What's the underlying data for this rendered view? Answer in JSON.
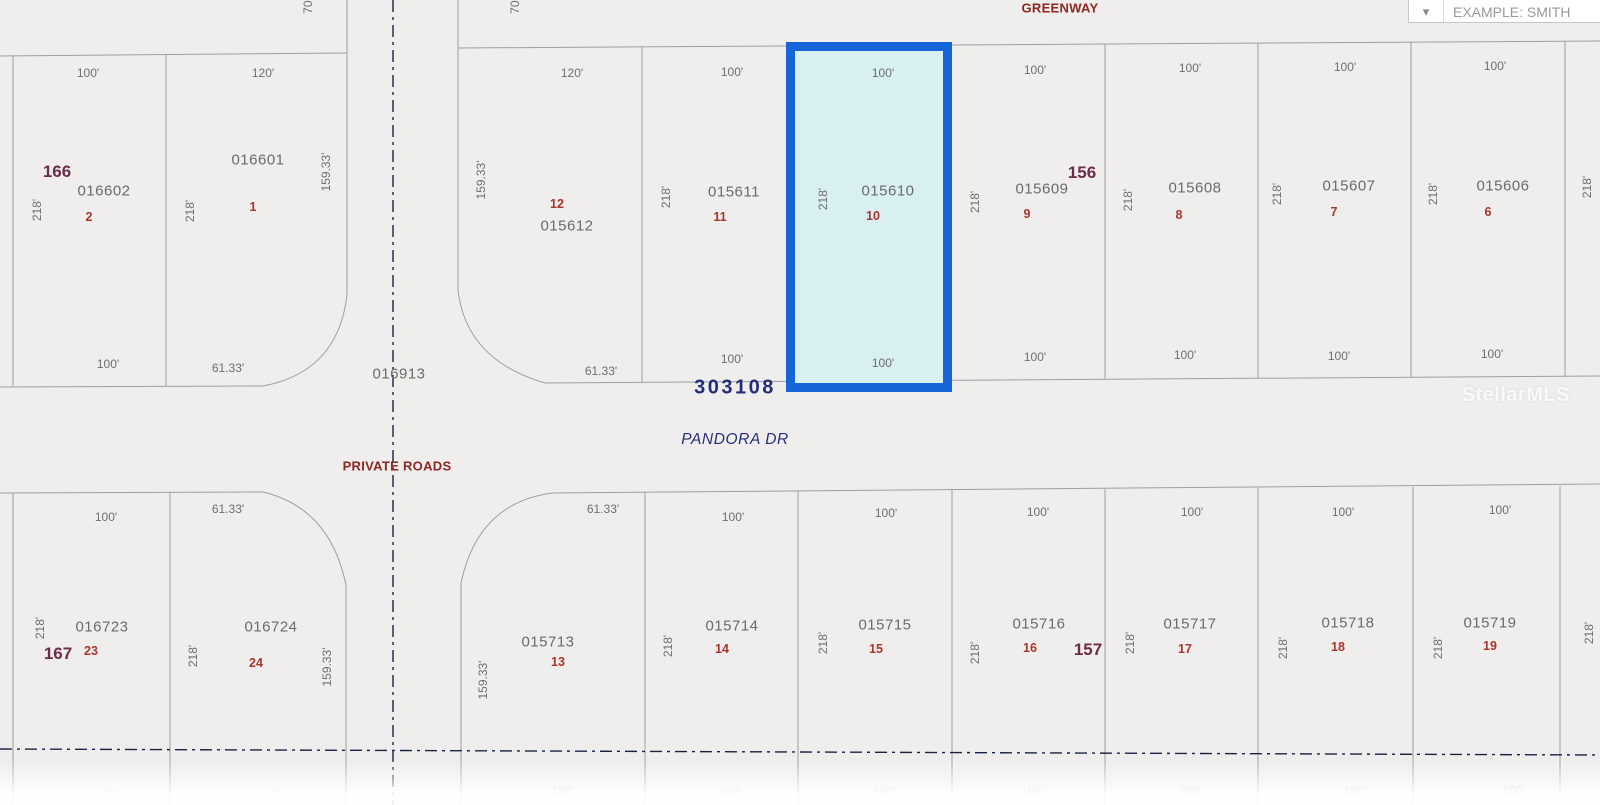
{
  "header": {
    "parcel_search": {
      "value": "EXAMPLE: SMITH",
      "chevron": "chevron-down-icon"
    }
  },
  "watermark": {
    "text": "StellarMLS"
  },
  "map": {
    "type": "plat-parcel-map",
    "streets": [
      "GREENWAY",
      "PANDORA DR",
      "PRIVATE ROADS"
    ],
    "block_numbers": [
      "166",
      "156",
      "167",
      "157"
    ],
    "plat_number": "303108",
    "road_parcel_id": "016913",
    "highlighted_parcel": {
      "parcel_id": "015610",
      "lot": "10",
      "frontage": "100'",
      "depth": "218'",
      "highlight_fill": "#d9f0f2",
      "highlight_border": "#1565d8"
    },
    "parcels": {
      "upper_left_block_166": [
        {
          "id": "016602",
          "lot": "2"
        },
        {
          "id": "016601",
          "lot": "1"
        }
      ],
      "upper_right_block_156": [
        {
          "id": "015612",
          "lot": "12"
        },
        {
          "id": "015611",
          "lot": "11"
        },
        {
          "id": "015610",
          "lot": "10"
        },
        {
          "id": "015609",
          "lot": "9"
        },
        {
          "id": "015608",
          "lot": "8"
        },
        {
          "id": "015607",
          "lot": "7"
        },
        {
          "id": "015606",
          "lot": "6"
        }
      ],
      "lower_left_block_167": [
        {
          "id": "016723",
          "lot": "23"
        },
        {
          "id": "016724",
          "lot": "24"
        }
      ],
      "lower_right_block_157": [
        {
          "id": "015713",
          "lot": "13"
        },
        {
          "id": "015714",
          "lot": "14"
        },
        {
          "id": "015715",
          "lot": "15"
        },
        {
          "id": "015716",
          "lot": "16"
        },
        {
          "id": "015717",
          "lot": "17"
        },
        {
          "id": "015718",
          "lot": "18"
        },
        {
          "id": "015719",
          "lot": "19"
        }
      ]
    },
    "labels": [
      {
        "text": "70'",
        "type": "dimv",
        "x": 308,
        "y": 6
      },
      {
        "text": "70'",
        "type": "dimv",
        "x": 515,
        "y": 6
      },
      {
        "text": "GREENWAY",
        "type": "street",
        "x": 1060,
        "y": 8
      },
      {
        "text": "100'",
        "type": "dim",
        "x": 88,
        "y": 73
      },
      {
        "text": "120'",
        "type": "dim",
        "x": 263,
        "y": 73
      },
      {
        "text": "166",
        "type": "block",
        "x": 57,
        "y": 172
      },
      {
        "text": "016602",
        "type": "pid",
        "x": 104,
        "y": 191
      },
      {
        "text": "2",
        "type": "lot",
        "x": 89,
        "y": 217
      },
      {
        "text": "218'",
        "type": "dimv",
        "x": 37,
        "y": 210
      },
      {
        "text": "016601",
        "type": "pid",
        "x": 258,
        "y": 160
      },
      {
        "text": "1",
        "type": "lot",
        "x": 253,
        "y": 207
      },
      {
        "text": "218'",
        "type": "dimv",
        "x": 190,
        "y": 211
      },
      {
        "text": "159.33'",
        "type": "dimv",
        "x": 326,
        "y": 172
      },
      {
        "text": "100'",
        "type": "dim",
        "x": 108,
        "y": 364
      },
      {
        "text": "61.33'",
        "type": "dim",
        "x": 228,
        "y": 368
      },
      {
        "text": "016913",
        "type": "pid",
        "x": 399,
        "y": 374
      },
      {
        "text": "PRIVATE ROADS",
        "type": "street",
        "x": 397,
        "y": 466
      },
      {
        "text": "120'",
        "type": "dim",
        "x": 572,
        "y": 73
      },
      {
        "text": "159.33'",
        "type": "dimv",
        "x": 481,
        "y": 180
      },
      {
        "text": "12",
        "type": "lot",
        "x": 557,
        "y": 204
      },
      {
        "text": "015612",
        "type": "pid",
        "x": 567,
        "y": 226
      },
      {
        "text": "61.33'",
        "type": "dim",
        "x": 601,
        "y": 371
      },
      {
        "text": "100'",
        "type": "dim",
        "x": 732,
        "y": 72
      },
      {
        "text": "218'",
        "type": "dimv",
        "x": 666,
        "y": 197
      },
      {
        "text": "015611",
        "type": "pid",
        "x": 734,
        "y": 192
      },
      {
        "text": "11",
        "type": "lot",
        "x": 720,
        "y": 217
      },
      {
        "text": "100'",
        "type": "dim",
        "x": 732,
        "y": 359
      },
      {
        "text": "303108",
        "type": "navy-big",
        "x": 735,
        "y": 388
      },
      {
        "text": "100'",
        "type": "dim",
        "x": 883,
        "y": 73
      },
      {
        "text": "218'",
        "type": "dimv",
        "x": 823,
        "y": 199
      },
      {
        "text": "015610",
        "type": "pid",
        "x": 888,
        "y": 191
      },
      {
        "text": "10",
        "type": "lot",
        "x": 873,
        "y": 216
      },
      {
        "text": "100'",
        "type": "dim",
        "x": 883,
        "y": 363
      },
      {
        "text": "100'",
        "type": "dim",
        "x": 1035,
        "y": 70
      },
      {
        "text": "156",
        "type": "block",
        "x": 1082,
        "y": 173
      },
      {
        "text": "218'",
        "type": "dimv",
        "x": 975,
        "y": 202
      },
      {
        "text": "015609",
        "type": "pid",
        "x": 1042,
        "y": 189
      },
      {
        "text": "9",
        "type": "lot",
        "x": 1027,
        "y": 214
      },
      {
        "text": "100'",
        "type": "dim",
        "x": 1035,
        "y": 357
      },
      {
        "text": "100'",
        "type": "dim",
        "x": 1190,
        "y": 68
      },
      {
        "text": "218'",
        "type": "dimv",
        "x": 1128,
        "y": 200
      },
      {
        "text": "015608",
        "type": "pid",
        "x": 1195,
        "y": 188
      },
      {
        "text": "8",
        "type": "lot",
        "x": 1179,
        "y": 215
      },
      {
        "text": "100'",
        "type": "dim",
        "x": 1185,
        "y": 355
      },
      {
        "text": "100'",
        "type": "dim",
        "x": 1345,
        "y": 67
      },
      {
        "text": "218'",
        "type": "dimv",
        "x": 1277,
        "y": 194
      },
      {
        "text": "015607",
        "type": "pid",
        "x": 1349,
        "y": 186
      },
      {
        "text": "7",
        "type": "lot",
        "x": 1334,
        "y": 212
      },
      {
        "text": "100'",
        "type": "dim",
        "x": 1339,
        "y": 356
      },
      {
        "text": "100'",
        "type": "dim",
        "x": 1495,
        "y": 66
      },
      {
        "text": "218'",
        "type": "dimv",
        "x": 1433,
        "y": 194
      },
      {
        "text": "015606",
        "type": "pid",
        "x": 1503,
        "y": 186
      },
      {
        "text": "6",
        "type": "lot",
        "x": 1488,
        "y": 212
      },
      {
        "text": "100'",
        "type": "dim",
        "x": 1492,
        "y": 354
      },
      {
        "text": "218'",
        "type": "dimv",
        "x": 1587,
        "y": 187
      },
      {
        "text": "PANDORA DR",
        "type": "navy-italic",
        "x": 735,
        "y": 440
      },
      {
        "text": "100'",
        "type": "dim",
        "x": 106,
        "y": 517
      },
      {
        "text": "61.33'",
        "type": "dim",
        "x": 228,
        "y": 509
      },
      {
        "text": "218'",
        "type": "dimv",
        "x": 40,
        "y": 628
      },
      {
        "text": "016723",
        "type": "pid",
        "x": 102,
        "y": 627
      },
      {
        "text": "167",
        "type": "block",
        "x": 58,
        "y": 654
      },
      {
        "text": "23",
        "type": "lot",
        "x": 91,
        "y": 651
      },
      {
        "text": "016724",
        "type": "pid",
        "x": 271,
        "y": 627
      },
      {
        "text": "218'",
        "type": "dimv",
        "x": 193,
        "y": 656
      },
      {
        "text": "24",
        "type": "lot",
        "x": 256,
        "y": 663
      },
      {
        "text": "159.33'",
        "type": "dimv",
        "x": 327,
        "y": 667
      },
      {
        "text": "61.33'",
        "type": "dim",
        "x": 603,
        "y": 509
      },
      {
        "text": "159.33'",
        "type": "dimv",
        "x": 483,
        "y": 680
      },
      {
        "text": "015713",
        "type": "pid",
        "x": 548,
        "y": 642
      },
      {
        "text": "13",
        "type": "lot",
        "x": 558,
        "y": 662
      },
      {
        "text": "100'",
        "type": "dim",
        "x": 733,
        "y": 517
      },
      {
        "text": "218'",
        "type": "dimv",
        "x": 668,
        "y": 646
      },
      {
        "text": "015714",
        "type": "pid",
        "x": 732,
        "y": 626
      },
      {
        "text": "14",
        "type": "lot",
        "x": 722,
        "y": 649
      },
      {
        "text": "100'",
        "type": "dim",
        "x": 886,
        "y": 513
      },
      {
        "text": "218'",
        "type": "dimv",
        "x": 823,
        "y": 643
      },
      {
        "text": "015715",
        "type": "pid",
        "x": 885,
        "y": 625
      },
      {
        "text": "15",
        "type": "lot",
        "x": 876,
        "y": 649
      },
      {
        "text": "100'",
        "type": "dim",
        "x": 1038,
        "y": 512
      },
      {
        "text": "218'",
        "type": "dimv",
        "x": 975,
        "y": 653
      },
      {
        "text": "015716",
        "type": "pid",
        "x": 1039,
        "y": 624
      },
      {
        "text": "16",
        "type": "lot",
        "x": 1030,
        "y": 648
      },
      {
        "text": "157",
        "type": "block",
        "x": 1088,
        "y": 650
      },
      {
        "text": "100'",
        "type": "dim",
        "x": 1192,
        "y": 512
      },
      {
        "text": "218'",
        "type": "dimv",
        "x": 1130,
        "y": 643
      },
      {
        "text": "015717",
        "type": "pid",
        "x": 1190,
        "y": 624
      },
      {
        "text": "17",
        "type": "lot",
        "x": 1185,
        "y": 649
      },
      {
        "text": "100'",
        "type": "dim",
        "x": 1343,
        "y": 512
      },
      {
        "text": "218'",
        "type": "dimv",
        "x": 1283,
        "y": 648
      },
      {
        "text": "015718",
        "type": "pid",
        "x": 1348,
        "y": 623
      },
      {
        "text": "18",
        "type": "lot",
        "x": 1338,
        "y": 647
      },
      {
        "text": "100'",
        "type": "dim",
        "x": 1500,
        "y": 510
      },
      {
        "text": "218'",
        "type": "dimv",
        "x": 1438,
        "y": 648
      },
      {
        "text": "015719",
        "type": "pid",
        "x": 1490,
        "y": 623
      },
      {
        "text": "19",
        "type": "lot",
        "x": 1490,
        "y": 646
      },
      {
        "text": "218'",
        "type": "dimv",
        "x": 1589,
        "y": 633
      },
      {
        "text": "120'",
        "type": "dim",
        "x": 562,
        "y": 791,
        "op": 0.38
      },
      {
        "text": "100'",
        "type": "dim",
        "x": 730,
        "y": 792,
        "op": 0.38
      },
      {
        "text": "100'",
        "type": "dim",
        "x": 884,
        "y": 792,
        "op": 0.38
      },
      {
        "text": "100'",
        "type": "dim",
        "x": 1032,
        "y": 792,
        "op": 0.38
      },
      {
        "text": "100'",
        "type": "dim",
        "x": 1190,
        "y": 791,
        "op": 0.38
      },
      {
        "text": "100'",
        "type": "dim",
        "x": 1355,
        "y": 791,
        "op": 0.38
      },
      {
        "text": "100'",
        "type": "dim",
        "x": 1513,
        "y": 790,
        "op": 0.38
      },
      {
        "text": "100'",
        "type": "dim",
        "x": 107,
        "y": 794,
        "op": 0.15
      },
      {
        "text": "120'",
        "type": "dim",
        "x": 270,
        "y": 794,
        "op": 0.15
      }
    ]
  }
}
